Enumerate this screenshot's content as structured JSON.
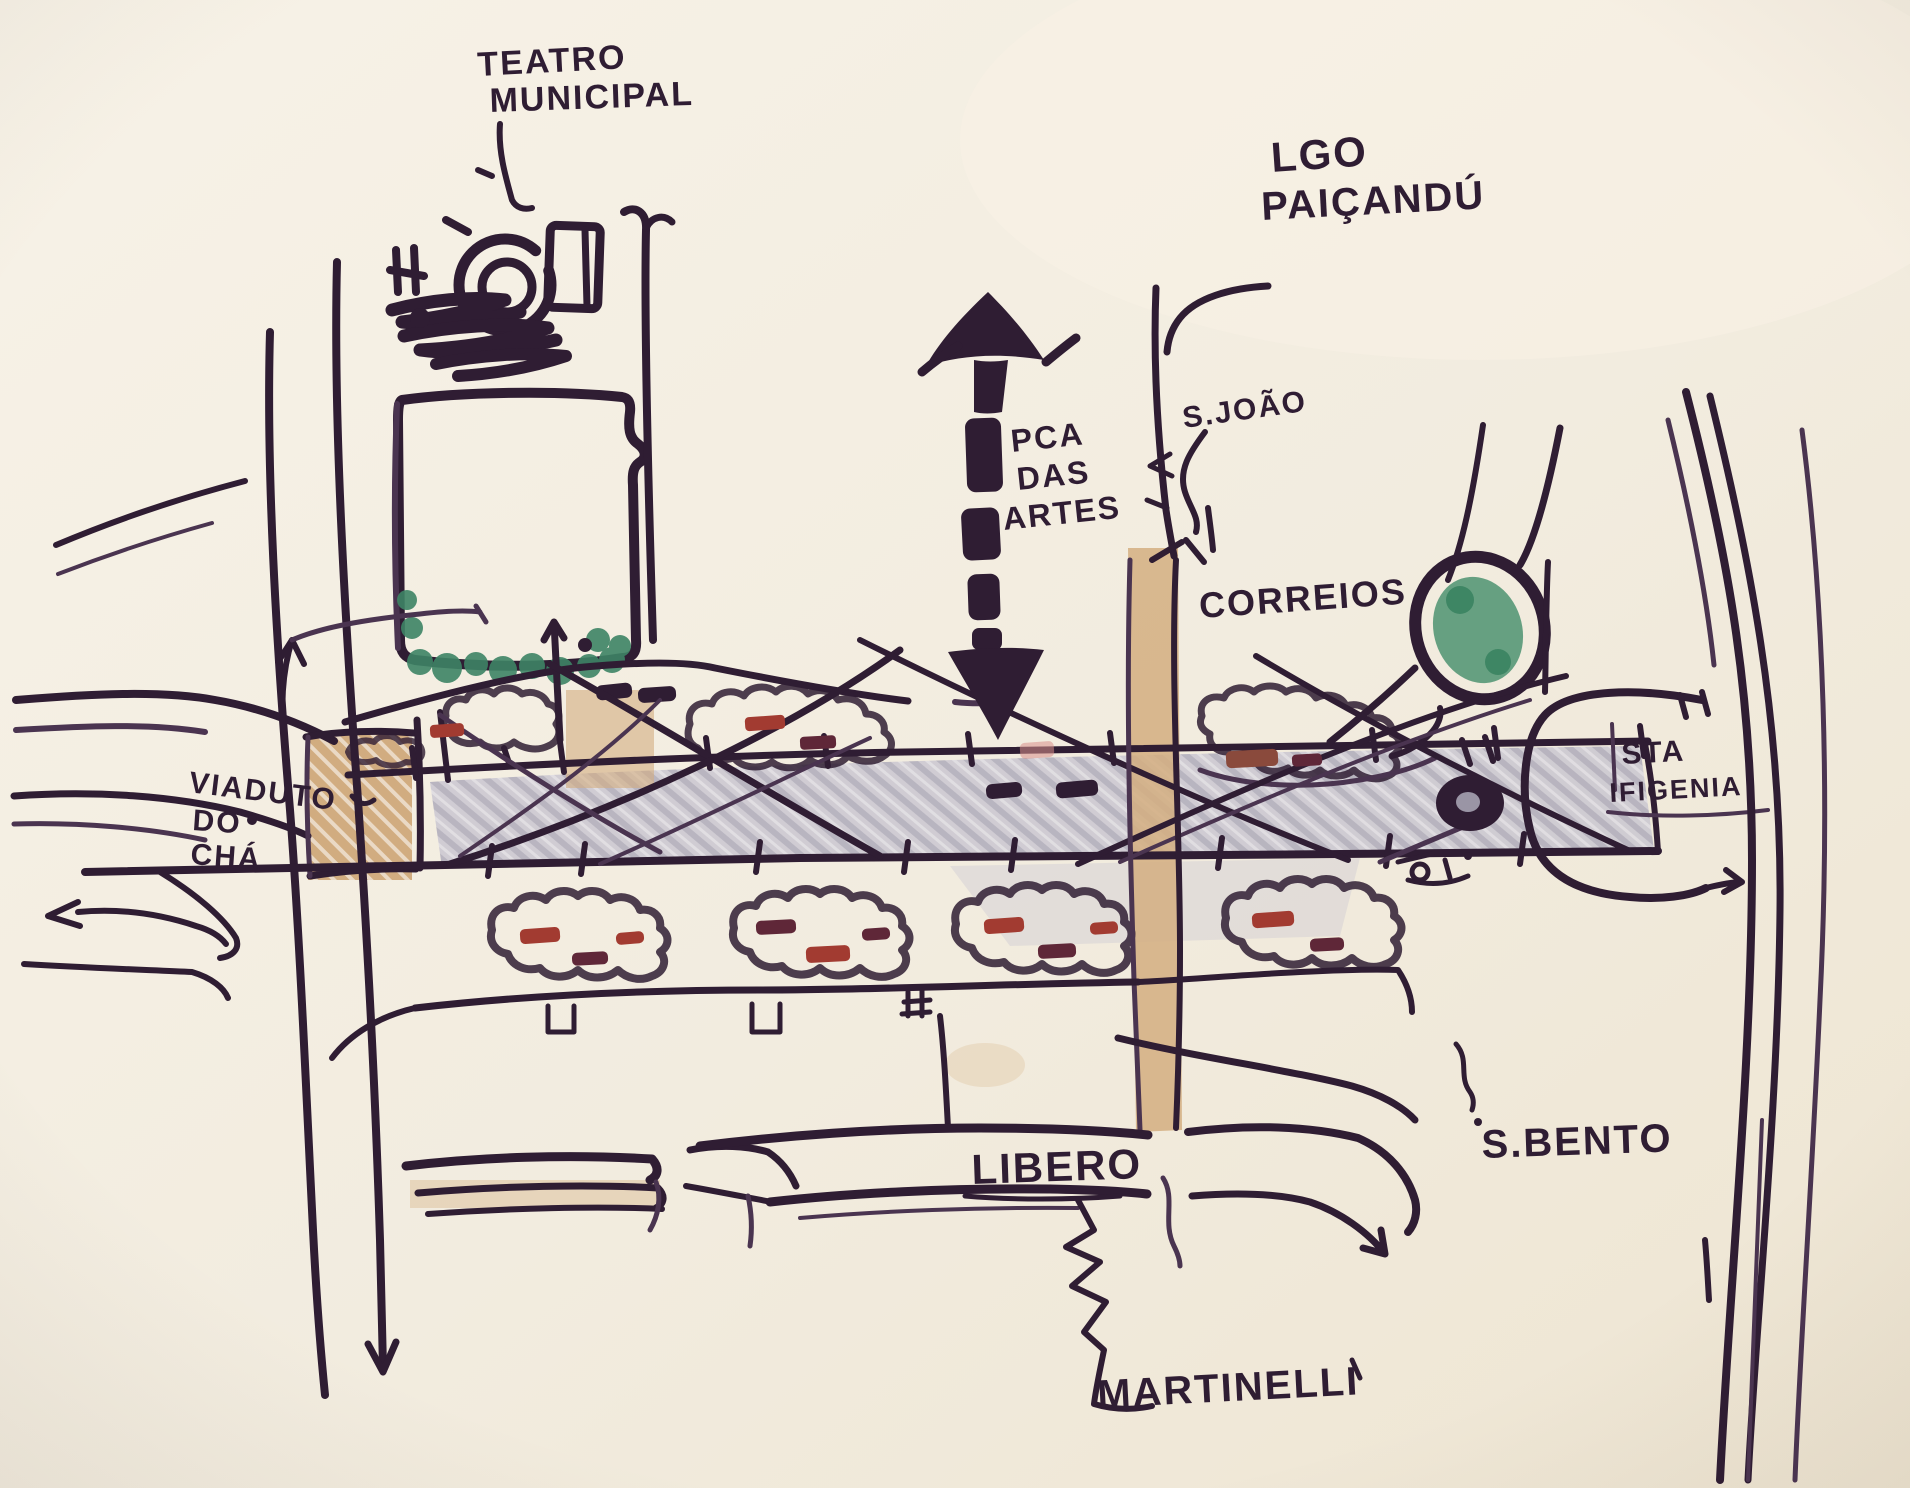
{
  "labels": {
    "teatro_municipal": {
      "line1": "TEATRO",
      "line2": "MUNICIPAL"
    },
    "lgo_paicandu": {
      "line1": "LGO",
      "line2": "PAIÇANDÚ"
    },
    "pca_das_artes": {
      "line1": "PCA",
      "line2": "DAS",
      "line3": "ARTES"
    },
    "s_joao": {
      "text": "S.JOÃO"
    },
    "correios": {
      "text": "CORREIOS"
    },
    "sta_ifigenia": {
      "line1": "STA",
      "line2": "IFIGENIA"
    },
    "viaduto_do_cha": {
      "line1": "VIADUTO",
      "line2": "DO",
      "line3": "CHÁ"
    },
    "libero": {
      "text": "LIBERO"
    },
    "s_bento": {
      "text": "S.BENTO"
    },
    "martinelli": {
      "text": "MARTINELLI"
    }
  },
  "colors": {
    "paper": "#f2ecdf",
    "ink": "#2f1d33",
    "green": "#4e9371",
    "green_hatch": "#9fc4ad",
    "tan": "#cfa97b",
    "gray": "#c5c2ce",
    "red": "#a23b31",
    "maroon": "#5f2738"
  }
}
